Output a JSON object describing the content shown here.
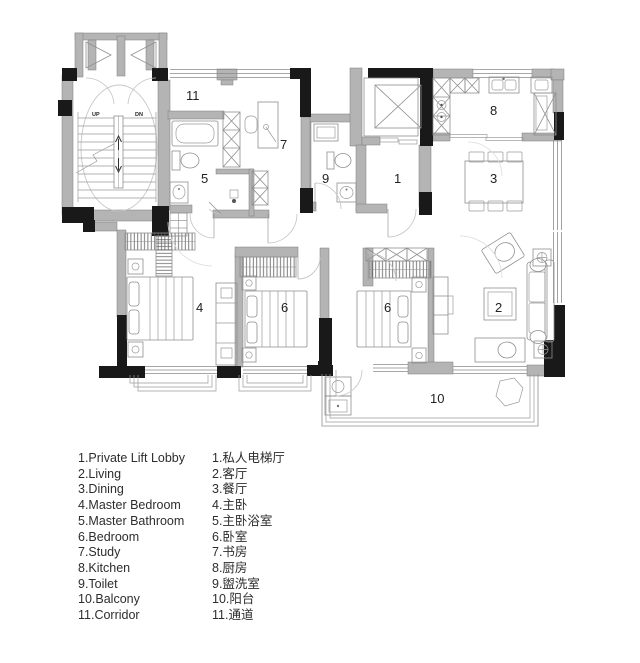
{
  "plan": {
    "rooms": {
      "private_lift_lobby": "1",
      "living": "2",
      "dining": "3",
      "master_bedroom": "4",
      "master_bathroom": "5",
      "bedroom_left": "6",
      "bedroom_right": "6",
      "study": "7",
      "kitchen": "8",
      "toilet": "9",
      "balcony": "10",
      "corridor": "11"
    },
    "stairs": {
      "up": "UP",
      "down": "DN"
    }
  },
  "legend": {
    "english": [
      "1.Private Lift Lobby",
      "2.Living",
      "3.Dining",
      "4.Master Bedroom",
      "5.Master Bathroom",
      "6.Bedroom",
      "7.Study",
      "8.Kitchen",
      "9.Toilet",
      "10.Balcony",
      "11.Corridor"
    ],
    "chinese": [
      "1.私人电梯厅",
      "2.客厅",
      "3.餐厅",
      "4.主卧",
      "5.主卧浴室",
      "6.卧室",
      "7.书房",
      "8.厨房",
      "9.盥洗室",
      "10.阳台",
      "11.通道"
    ]
  },
  "colors": {
    "wall_gray": "#b4b4b4",
    "wall_black": "#191919",
    "furniture_line": "#8f8f8f",
    "text": "#2d2d2d",
    "background": "#ffffff"
  }
}
